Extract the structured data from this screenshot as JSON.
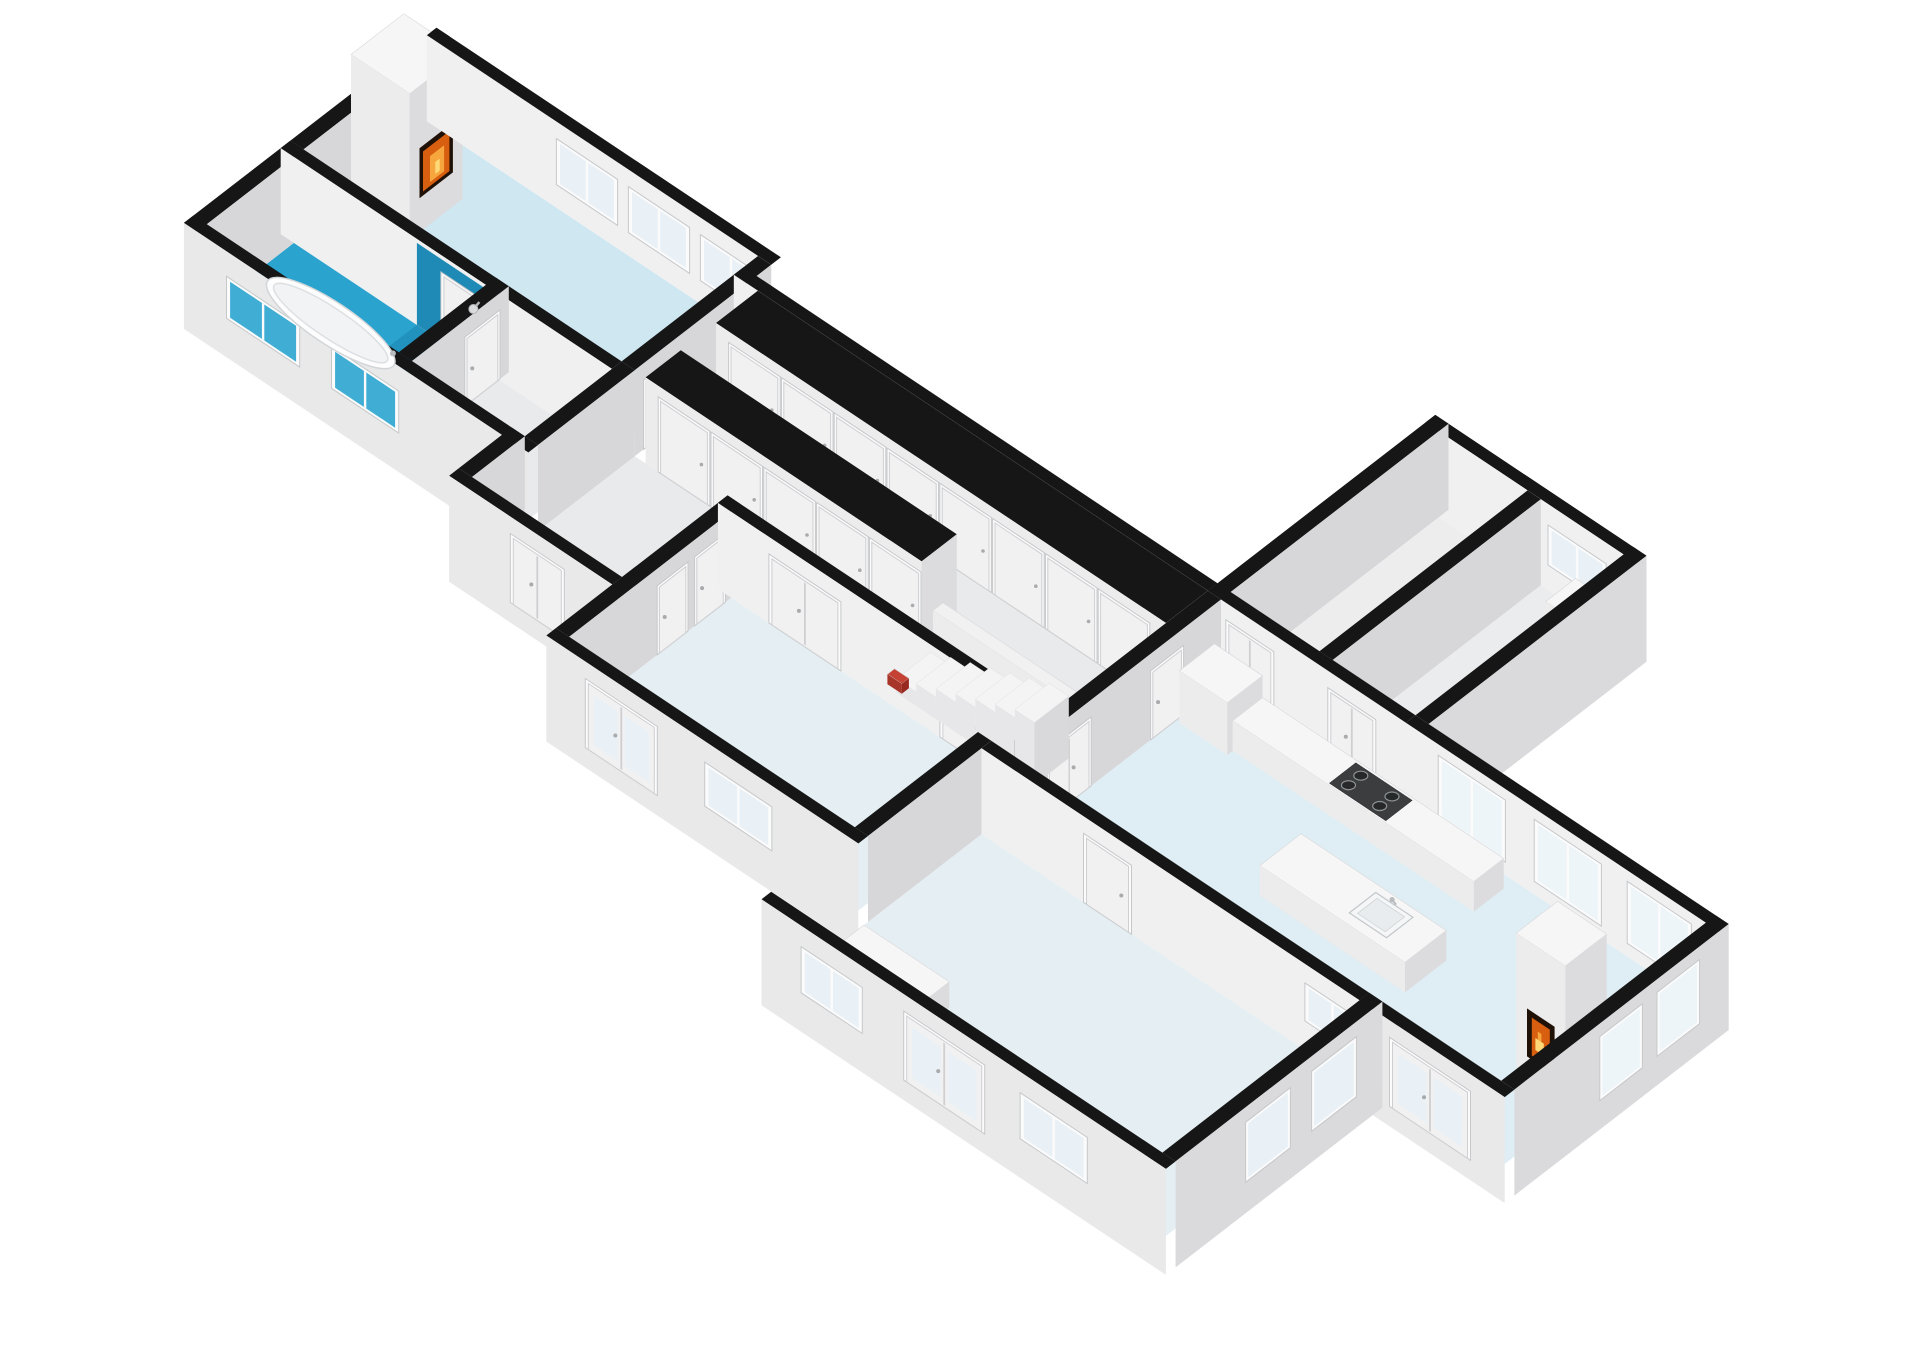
{
  "meta": {
    "background": "#ffffff",
    "figure": "isometric-3d-floor-plan"
  },
  "scene": {
    "projection": {
      "ox": 440,
      "oy": 130,
      "ax": 60,
      "ay": 40,
      "bx": -44,
      "by": 34,
      "wall_height": 86,
      "plinth": 20,
      "thickness": 0.22
    },
    "palette": {
      "wall_top": "#161616",
      "face_s_int": "#f0f0f0",
      "face_s_ext": "#e9e9e9",
      "face_e": "#d7d7d9",
      "face_e_ext": "#dadadc",
      "box_top": "#f6f6f7",
      "box_s": "#ececed",
      "box_e": "#dcdcde",
      "frame": "#fbfbfc",
      "frame_edge": "#c6c8ca",
      "glass": "#e9f1f6",
      "glass_bright": "#eef5f9",
      "glass_teal": "#3fadd4",
      "door": "#f1f1f2",
      "door_edge": "#cfcfd1",
      "floor_living": "#cfe7f1",
      "floor_bath": "#2aa3cf",
      "floor_shower": "#2191bd",
      "wall_shower": "#1f8ab5",
      "floor_gray": "#e9eaec",
      "floor_bedroom": "#e4eef3",
      "floor_kitchen": "#dfedf4",
      "floor_small": "#ededee",
      "fire_frame": "#201107",
      "fire_orange": "#d85f10",
      "fire_amber": "#f6a63c",
      "fire_glow": "#ffd977",
      "step_top": "#f4f4f5",
      "step_side": "#e7e7e9",
      "step_end": "#d9d9db",
      "accent_red": "#c44133",
      "accent_red_dark": "#a8352a",
      "metal": "#b9bdbf",
      "sink_rim": "#c2c7ca",
      "sink_bowl": "#f4f6f7",
      "stove_top": "#3b3d3f",
      "burner": "#26282a",
      "burner_ring": "#8e9497"
    },
    "floors": [
      {
        "name": "living-room-floor",
        "color": "#cfe7f1",
        "x1": 0,
        "y1": 0,
        "x2": 5.3,
        "y2": 3.1
      },
      {
        "name": "bathroom-floor",
        "color": "#2aa3cf",
        "x1": 0,
        "y1": 3.32,
        "x2": 3.2,
        "y2": 5.3
      },
      {
        "name": "shower-floor",
        "color": "#2191bd",
        "x1": 2.05,
        "y1": 3.32,
        "x2": 3.2,
        "y2": 4.18
      },
      {
        "name": "hall-west-floor",
        "color": "#e9eaec",
        "x1": 3.42,
        "y1": 3.32,
        "x2": 5.3,
        "y2": 5.3
      },
      {
        "name": "corridor-north-floor",
        "color": "#e9eaec",
        "x1": 5.52,
        "y1": 1.5,
        "x2": 13.2,
        "y2": 2.3
      },
      {
        "name": "corridor-south-floor",
        "color": "#e9eaec",
        "x1": 5.52,
        "y1": 3.1,
        "x2": 13.2,
        "y2": 4.1
      },
      {
        "name": "entry-hall-floor",
        "color": "#e9eaec",
        "x1": 5.52,
        "y1": 4.1,
        "x2": 7.8,
        "y2": 6.5
      },
      {
        "name": "bedroom-mid-floor",
        "color": "#e4eef3",
        "x1": 8.02,
        "y1": 4.32,
        "x2": 12.78,
        "y2": 8.0
      },
      {
        "name": "top-room-1-floor",
        "color": "#ededee",
        "x1": 13.42,
        "y1": -4.4,
        "x2": 14.9,
        "y2": 0.33
      },
      {
        "name": "top-room-2-floor",
        "color": "#eaeced",
        "x1": 15.12,
        "y1": -4.4,
        "x2": 16.5,
        "y2": 0.33
      },
      {
        "name": "kitchen-dining-floor",
        "color": "#dfedf4",
        "x1": 13.42,
        "y1": 0.55,
        "x2": 21.5,
        "y2": 5.2
      },
      {
        "name": "big-room-floor",
        "color": "#e4eef3",
        "x1": 13.0,
        "y1": 5.42,
        "x2": 19.3,
        "y2": 9.9
      }
    ],
    "walls": [
      {
        "name": "living-north-wall",
        "axis": "x",
        "y": -0.22,
        "x1": -0.22,
        "x2": 5.52,
        "ext": 1,
        "inner": 1,
        "windows": [
          [
            2.0,
            2.9,
            26,
            66
          ],
          [
            3.2,
            4.1,
            26,
            66
          ],
          [
            4.4,
            5.3,
            26,
            66
          ]
        ]
      },
      {
        "name": "corridor-north-wall",
        "axis": "x",
        "y": 0.33,
        "x1": 5.3,
        "x2": 13.2,
        "ext": 1,
        "inner": 1,
        "windows": [
          [
            6.15,
            6.95,
            28,
            64
          ],
          [
            8.05,
            8.85,
            28,
            64
          ],
          [
            11.3,
            12.1,
            28,
            64
          ]
        ]
      },
      {
        "name": "top-rooms-south-wall",
        "axis": "x",
        "y": 0.33,
        "x1": 13.2,
        "x2": 16.5,
        "doors": [
          [
            13.55,
            14.25,
            "d"
          ],
          [
            15.25,
            15.95,
            "d"
          ]
        ]
      },
      {
        "name": "top-rooms-north-wall",
        "axis": "x",
        "y": -4.62,
        "x1": 13.2,
        "x2": 16.72,
        "ext": 1,
        "inner": 1,
        "windows": [
          [
            15.3,
            16.15,
            28,
            62
          ]
        ]
      },
      {
        "name": "kitchen-north-wall",
        "axis": "x",
        "y": 0.33,
        "x1": 16.5,
        "x2": 21.72,
        "ext": 1,
        "inner": 1,
        "glass": "#eef5f9",
        "windows": [
          [
            17.1,
            18.1,
            16,
            72
          ],
          [
            18.7,
            19.7,
            16,
            72
          ],
          [
            20.25,
            21.2,
            16,
            72
          ]
        ]
      },
      {
        "name": "living-bath-wall",
        "axis": "x",
        "y": 3.1,
        "x1": -0.22,
        "x2": 5.3,
        "doors": [
          [
            2.5,
            3.12,
            "s"
          ]
        ],
        "teal": [
          2.05,
          3.2
        ]
      },
      {
        "name": "bath-south-wall",
        "axis": "x",
        "y": 5.3,
        "x1": -0.22,
        "x2": 5.52,
        "ext": 1,
        "glass": "#3fadd4",
        "windows": [
          [
            0.55,
            1.65,
            22,
            58
          ],
          [
            2.3,
            3.3,
            22,
            58
          ]
        ]
      },
      {
        "name": "bedroom-mid-north-wall",
        "axis": "x",
        "y": 4.1,
        "x1": 7.8,
        "x2": 13.0,
        "doors": [
          [
            8.7,
            9.8,
            "d"
          ],
          [
            11.55,
            12.2,
            "s"
          ]
        ]
      },
      {
        "name": "entry-south-wall",
        "axis": "x",
        "y": 6.5,
        "x1": 5.08,
        "x2": 7.8,
        "ext": 1,
        "doors": [
          [
            6.15,
            6.95,
            "d"
          ]
        ]
      },
      {
        "name": "bedroom-mid-south-wall",
        "axis": "x",
        "y": 8.0,
        "x1": 7.8,
        "x2": 13.0,
        "ext": 1,
        "doors": [
          [
            8.5,
            9.6,
            "dg"
          ]
        ],
        "windows": [
          [
            10.5,
            11.5,
            24,
            62
          ]
        ]
      },
      {
        "name": "big-room-north-wall",
        "axis": "x",
        "y": 5.2,
        "x1": 13.0,
        "x2": 19.3,
        "doors": [
          [
            14.75,
            15.45,
            "s"
          ]
        ],
        "windows": [
          [
            18.45,
            19.25,
            32,
            64
          ]
        ]
      },
      {
        "name": "kitchen-south-wall",
        "axis": "x",
        "y": 5.2,
        "x1": 19.3,
        "x2": 21.72,
        "ext": 1,
        "doors": [
          [
            19.85,
            21.1,
            "dg"
          ]
        ]
      },
      {
        "name": "big-room-south-wall",
        "axis": "x",
        "y": 9.9,
        "x1": 12.78,
        "x2": 19.52,
        "ext": 1,
        "windows": [
          [
            13.5,
            14.4,
            22,
            62
          ],
          [
            17.15,
            18.15,
            22,
            62
          ]
        ],
        "doors": [
          [
            15.2,
            16.45,
            "dg"
          ]
        ]
      },
      {
        "name": "living-west-wall",
        "axis": "y",
        "x": -0.22,
        "y1": -0.22,
        "y2": 3.1,
        "ext": 1,
        "inner": 1
      },
      {
        "name": "bath-west-wall",
        "axis": "y",
        "x": -0.22,
        "y1": 3.1,
        "y2": 5.52,
        "ext": 1,
        "inner": 1
      },
      {
        "name": "living-east-wall",
        "axis": "y",
        "x": 5.3,
        "y1": 0,
        "y2": 3.1,
        "doors": [
          [
            2.15,
            2.85,
            "s"
          ]
        ]
      },
      {
        "name": "bath-east-wall",
        "axis": "y",
        "x": 3.2,
        "y1": 3.1,
        "y2": 5.3,
        "doors": [
          [
            3.35,
            4.05,
            "s"
          ]
        ]
      },
      {
        "name": "hall-west-east-wall",
        "axis": "y",
        "x": 5.3,
        "y1": 3.1,
        "y2": 5.3
      },
      {
        "name": "entry-west-wall",
        "axis": "y",
        "x": 5.08,
        "y1": 5.3,
        "y2": 6.5
      },
      {
        "name": "kitchen-west-wall",
        "axis": "y",
        "x": 13.2,
        "y1": 0.55,
        "y2": 5.2,
        "doors": [
          [
            1.45,
            2.1,
            "s"
          ],
          [
            3.55,
            4.45,
            "d"
          ]
        ]
      },
      {
        "name": "top-rooms-west-wall",
        "axis": "y",
        "x": 13.2,
        "y1": -4.62,
        "y2": 0.55,
        "ext": 1,
        "inner": 1
      },
      {
        "name": "top-rooms-divider-wall",
        "axis": "y",
        "x": 14.9,
        "y1": -4.4,
        "y2": 0.33
      },
      {
        "name": "top-rooms-east-wall",
        "axis": "y",
        "x": 16.5,
        "y1": -4.62,
        "y2": 0.33,
        "ext": 1
      },
      {
        "name": "kitchen-east-wall",
        "axis": "y",
        "x": 21.5,
        "y1": 0.33,
        "y2": 5.2,
        "ext": 1,
        "glass": "#eef5f9",
        "windows": [
          [
            1.05,
            1.9,
            12,
            70
          ],
          [
            2.35,
            3.2,
            12,
            70
          ]
        ]
      },
      {
        "name": "big-room-east-wall",
        "axis": "y",
        "x": 19.3,
        "y1": 5.2,
        "y2": 9.9,
        "ext": 1,
        "windows": [
          [
            5.85,
            6.75,
            14,
            68
          ],
          [
            7.35,
            8.25,
            14,
            68
          ]
        ]
      },
      {
        "name": "bedroom-mid-west-wall",
        "axis": "y",
        "x": 7.8,
        "y1": 4.1,
        "y2": 8.0,
        "doors": [
          [
            4.5,
            5.1,
            "s"
          ],
          [
            5.35,
            5.95,
            "s"
          ]
        ]
      },
      {
        "name": "bedroom-big-divider-wall",
        "axis": "y",
        "x": 12.78,
        "y1": 5.2,
        "y2": 8.0
      }
    ],
    "boxes": [
      {
        "name": "closet-row-north",
        "x1": 5.7,
        "y1": 0.55,
        "x2": 13.2,
        "y2": 1.5,
        "h": 86,
        "black": 1,
        "doors": [
          [
            5.95,
            6.73
          ],
          [
            6.83,
            7.61
          ],
          [
            7.71,
            8.49
          ],
          [
            8.59,
            9.37
          ],
          [
            9.47,
            10.25
          ],
          [
            10.35,
            11.13
          ],
          [
            11.23,
            12.01
          ],
          [
            12.11,
            12.89
          ]
        ]
      },
      {
        "name": "closet-row-south",
        "x1": 5.7,
        "y1": 2.3,
        "x2": 10.3,
        "y2": 3.1,
        "h": 86,
        "black": 1,
        "doors": [
          [
            5.95,
            6.73
          ],
          [
            6.83,
            7.61
          ],
          [
            7.71,
            8.49
          ],
          [
            8.59,
            9.37
          ],
          [
            9.47,
            10.25
          ]
        ]
      },
      {
        "name": "stair-balustrade",
        "x1": 10.6,
        "y1": 3.02,
        "x2": 12.9,
        "y2": 3.25,
        "h": 54,
        "top": "#f1f1f2",
        "z": -1.5
      },
      {
        "name": "living-fireplace-chimney",
        "x1": 0.02,
        "y1": 0.85,
        "x2": 1.0,
        "y2": 2.05,
        "h": 146,
        "top": "#f6f6f7",
        "fire": "e"
      },
      {
        "name": "kitchen-fireplace-chimney",
        "x1": 20.62,
        "y1": 2.72,
        "x2": 21.44,
        "y2": 3.66,
        "h": 146,
        "top": "#f6f6f7",
        "fire": "s"
      },
      {
        "name": "kitchen-tall-cabinet",
        "x1": 13.48,
        "y1": 0.78,
        "x2": 14.28,
        "y2": 1.58,
        "h": 52,
        "z": 3
      },
      {
        "name": "kitchen-counter",
        "x1": 14.28,
        "y1": 0.78,
        "x2": 18.3,
        "y2": 1.46,
        "h": 30,
        "z": 3
      },
      {
        "name": "kitchen-island",
        "x1": 16.2,
        "y1": 2.52,
        "x2": 18.62,
        "y2": 3.46,
        "h": 30,
        "z": 3
      },
      {
        "name": "big-room-cabinet",
        "x1": 13.3,
        "y1": 8.5,
        "x2": 14.72,
        "y2": 9.68,
        "h": 26,
        "z": 2
      },
      {
        "name": "top-room-2-ledge",
        "x1": 15.7,
        "y1": -4.4,
        "x2": 16.5,
        "y2": -3.72,
        "h": 30,
        "z": 1
      },
      {
        "name": "stair-base-accent",
        "x1": 10.42,
        "y1": 3.88,
        "x2": 10.66,
        "y2": 4.04,
        "h": 10,
        "top": "#c44133",
        "s": "#a8352a",
        "e": "#98291f",
        "z": 3
      }
    ],
    "stairs": {
      "name": "staircase",
      "x1": 10.6,
      "x2": 12.9,
      "y1": 3.3,
      "y2": 4.08,
      "steps": 7,
      "rise": 8,
      "base": 6
    },
    "stove": {
      "name": "stove-cooktop",
      "x1": 15.88,
      "y1": 0.84,
      "x2": 16.82,
      "y2": 1.44,
      "h": 31,
      "burners": [
        [
          16.08,
          1.0
        ],
        [
          16.08,
          1.28
        ],
        [
          16.6,
          1.0
        ],
        [
          16.6,
          1.28
        ]
      ]
    },
    "sinks": [
      {
        "name": "island-sink-1",
        "x1": 16.66,
        "y1": 2.68,
        "x2": 17.28,
        "y2": 3.28,
        "h": 31
      },
      {
        "name": "island-sink-2",
        "x1": 17.56,
        "y1": 2.68,
        "x2": 18.18,
        "y2": 3.28,
        "h": 31
      }
    ],
    "tub": {
      "name": "bathtub",
      "cx": 1.42,
      "cy": 4.42,
      "rx": 76,
      "ry": 21,
      "rot": 33.7,
      "z": 3
    },
    "shower_head": {
      "name": "shower-head",
      "u": 3.02,
      "v": 3.36,
      "h": 56
    }
  }
}
